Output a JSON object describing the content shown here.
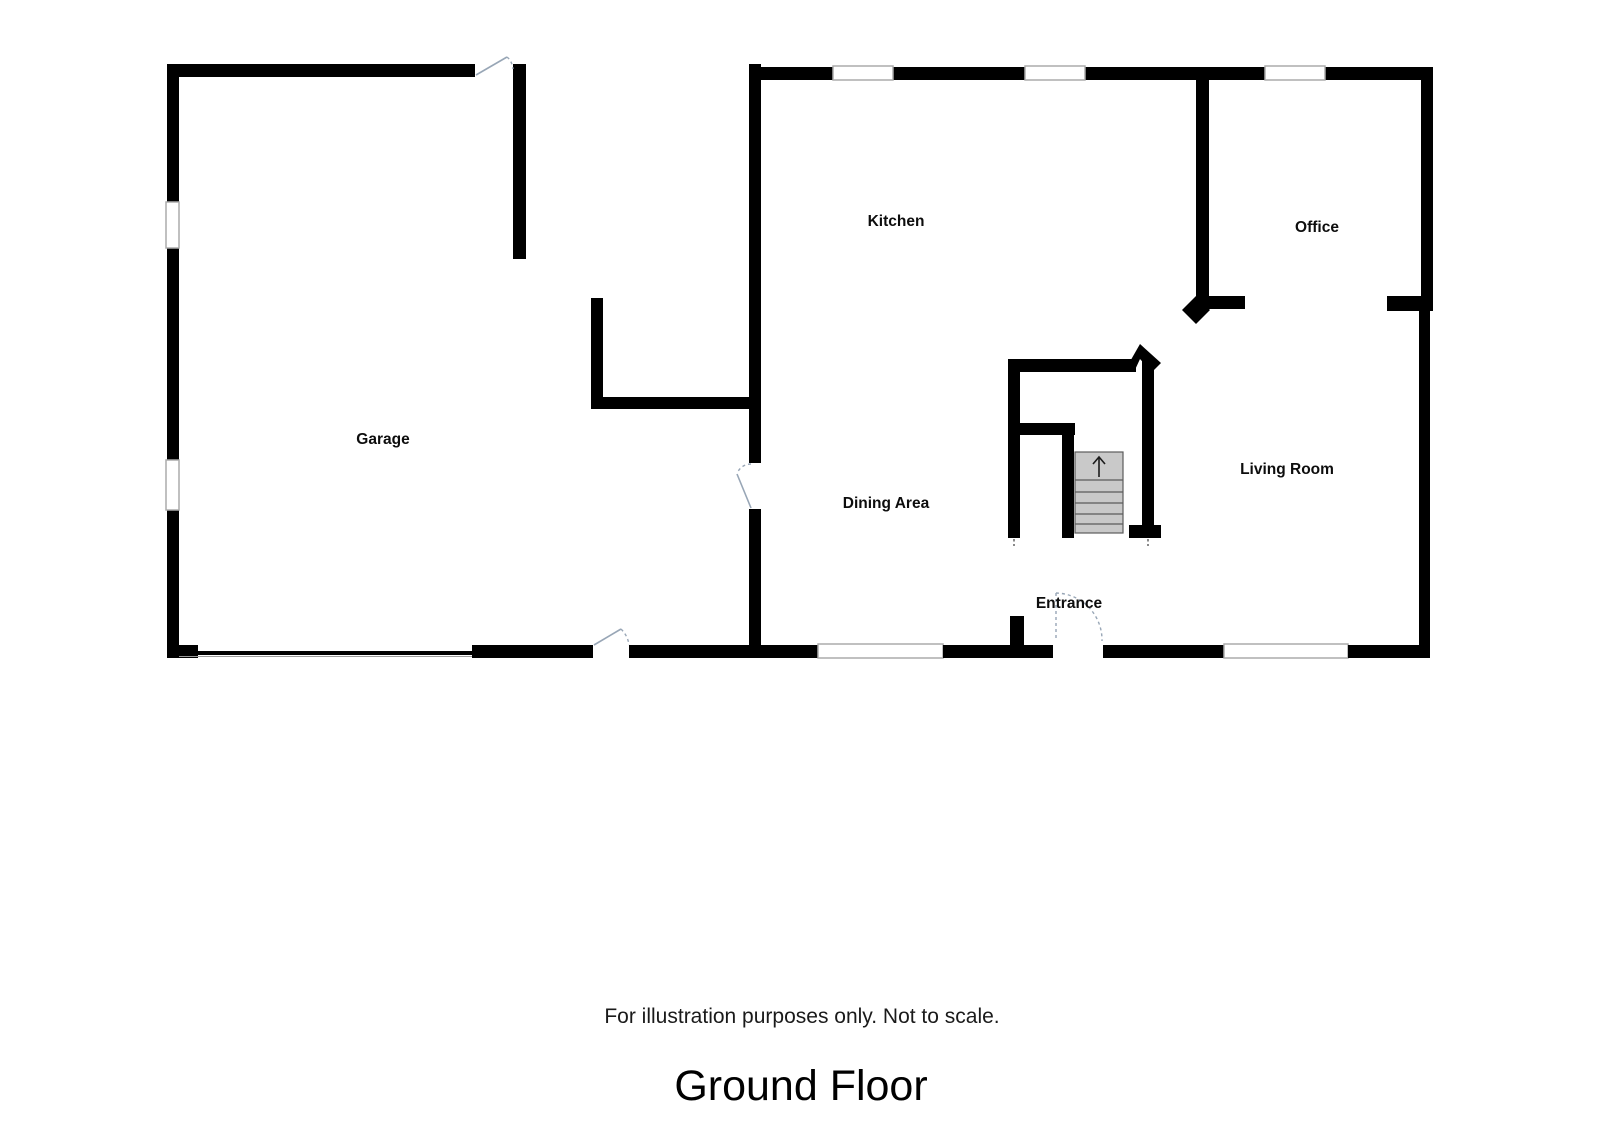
{
  "title": "Ground Floor",
  "disclaimer": "For illustration purposes only. Not to scale.",
  "rooms": {
    "garage": "Garage",
    "kitchen": "Kitchen",
    "office": "Office",
    "dining": "Dining Area",
    "living": "Living Room",
    "entrance": "Entrance"
  },
  "stairs": {
    "direction": "up"
  },
  "colors": {
    "wall": "#000000",
    "stair_fill": "#c9c9c9",
    "door_swing": "#98a6b6",
    "window_outline": "#ababab"
  }
}
